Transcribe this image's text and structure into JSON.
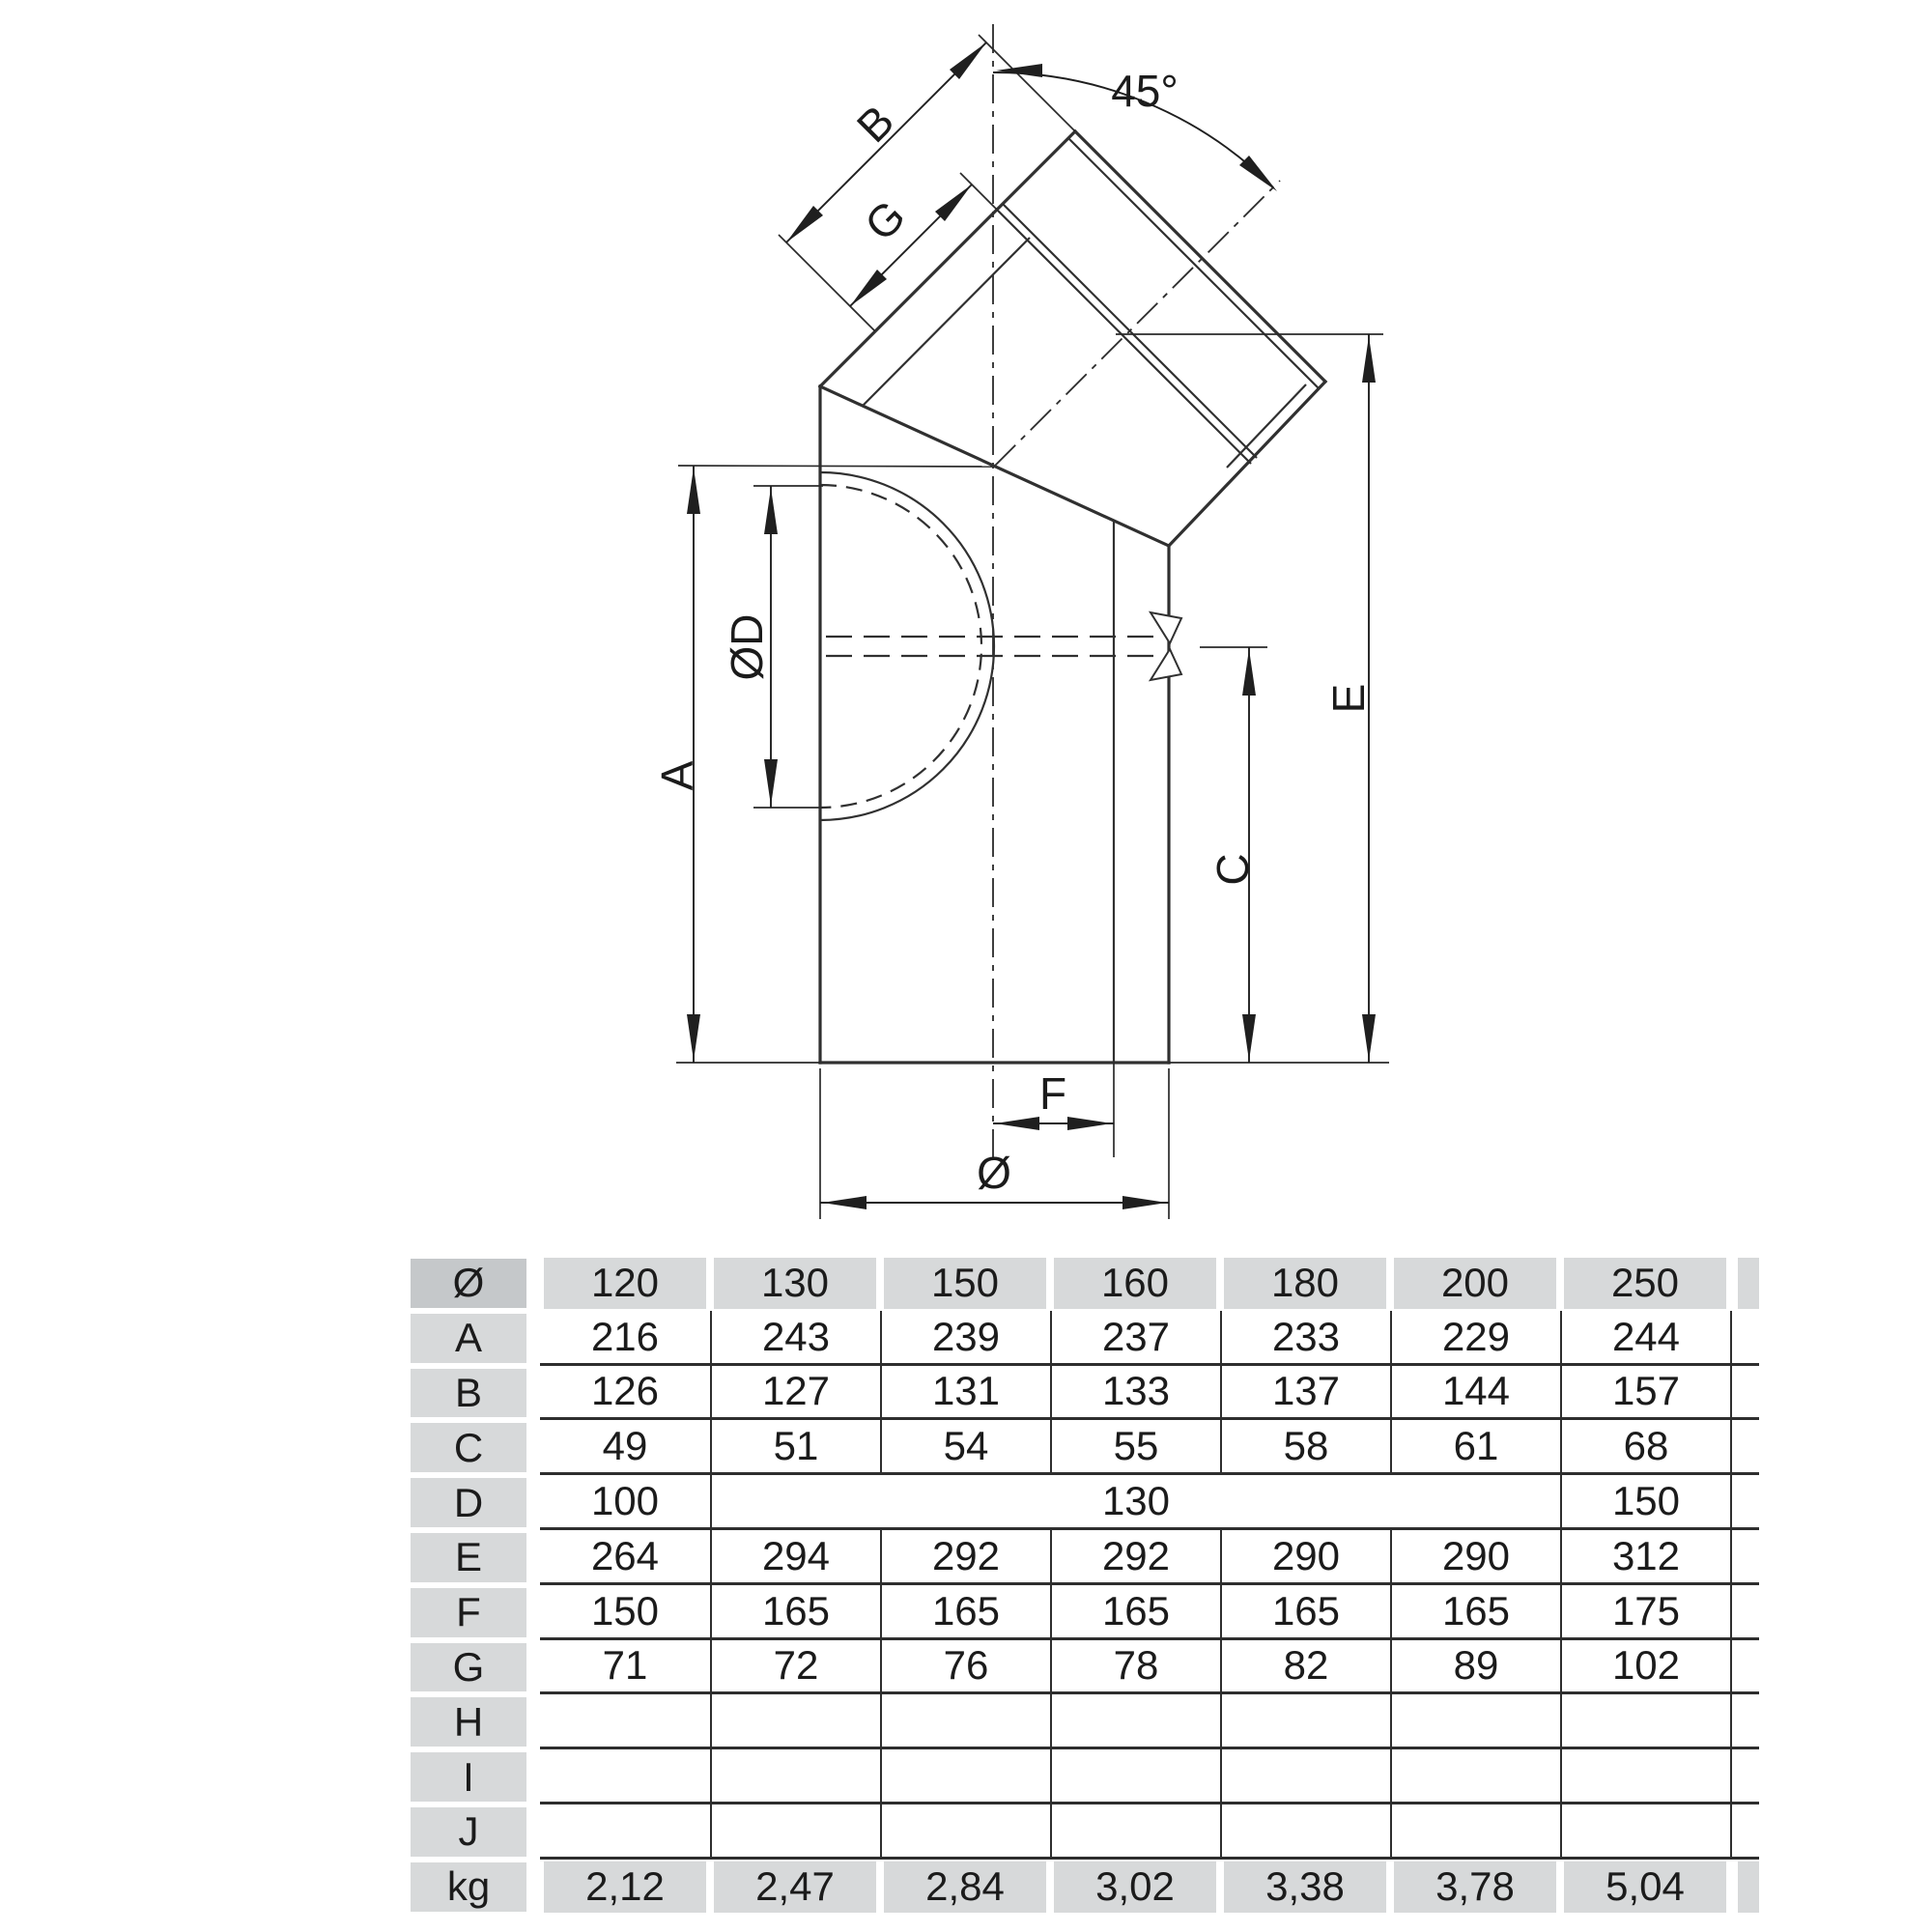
{
  "drawing": {
    "angle_label": "45°",
    "dim_labels": {
      "a": "A",
      "b": "B",
      "c": "C",
      "od": "ØD",
      "e": "E",
      "f": "F",
      "g": "G",
      "dia": "Ø"
    }
  },
  "table": {
    "header_label": "Ø",
    "diameters": [
      "120",
      "130",
      "150",
      "160",
      "180",
      "200",
      "250"
    ],
    "rows": [
      {
        "label": "A",
        "values": [
          "216",
          "243",
          "239",
          "237",
          "233",
          "229",
          "244"
        ]
      },
      {
        "label": "B",
        "values": [
          "126",
          "127",
          "131",
          "133",
          "137",
          "144",
          "157"
        ]
      },
      {
        "label": "C",
        "values": [
          "49",
          "51",
          "54",
          "55",
          "58",
          "61",
          "68"
        ]
      },
      {
        "label": "D",
        "merged": true,
        "left": "100",
        "mid": "130",
        "right": "150"
      },
      {
        "label": "E",
        "values": [
          "264",
          "294",
          "292",
          "292",
          "290",
          "290",
          "312"
        ]
      },
      {
        "label": "F",
        "values": [
          "150",
          "165",
          "165",
          "165",
          "165",
          "165",
          "175"
        ]
      },
      {
        "label": "G",
        "values": [
          "71",
          "72",
          "76",
          "78",
          "82",
          "89",
          "102"
        ]
      },
      {
        "label": "H",
        "values": [
          "",
          "",
          "",
          "",
          "",
          "",
          ""
        ]
      },
      {
        "label": "I",
        "values": [
          "",
          "",
          "",
          "",
          "",
          "",
          ""
        ]
      },
      {
        "label": "J",
        "values": [
          "",
          "",
          "",
          "",
          "",
          "",
          ""
        ]
      }
    ],
    "footer": {
      "label": "kg",
      "values": [
        "2,12",
        "2,47",
        "2,84",
        "3,02",
        "3,38",
        "3,78",
        "5,04"
      ]
    }
  },
  "colors": {
    "line": "#2a2a2a",
    "cell_gray": "#d7d9da",
    "corner_gray": "#c5c8ca"
  }
}
